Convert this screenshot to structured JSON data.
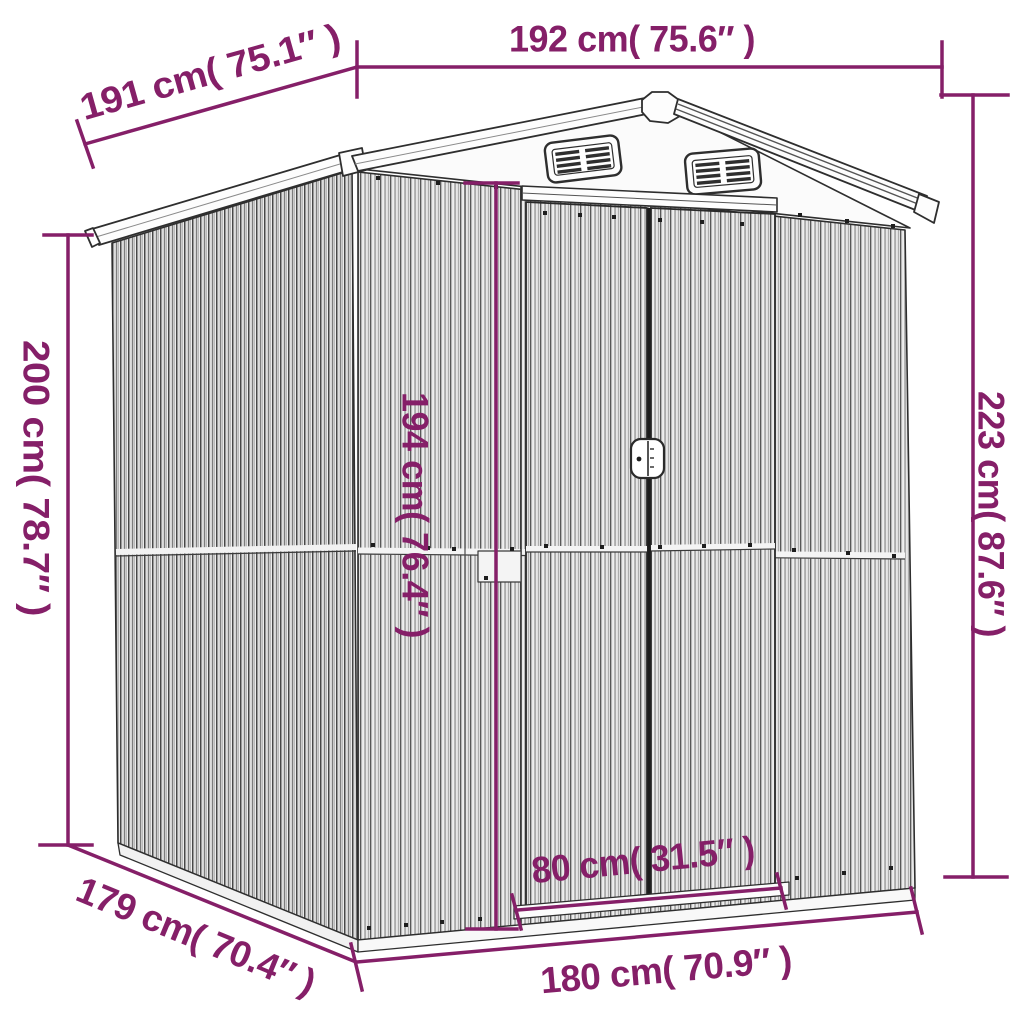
{
  "colors": {
    "dimension": "#851f68",
    "line_art": "#2e2e2e",
    "background": "#ffffff"
  },
  "drawing": {
    "subject": "garden-shed-line-art"
  },
  "dimensions": {
    "top_depth": {
      "cm": 191,
      "inch": 75.1,
      "label": "191 cm( 75.1″ )"
    },
    "top_width": {
      "cm": 192,
      "inch": 75.6,
      "label": "192 cm( 75.6″ )"
    },
    "left_height": {
      "cm": 200,
      "inch": 78.7,
      "label": "200 cm( 78.7″ )"
    },
    "right_height": {
      "cm": 223,
      "inch": 87.6,
      "label": "223 cm( 87.6″ )"
    },
    "door_height": {
      "cm": 194,
      "inch": 76.4,
      "label": "194 cm( 76.4″ )"
    },
    "door_width": {
      "cm": 80,
      "inch": 31.5,
      "label": "80 cm( 31.5″ )"
    },
    "base_width": {
      "cm": 180,
      "inch": 70.9,
      "label": "180 cm( 70.9″ )"
    },
    "base_depth": {
      "cm": 179,
      "inch": 70.4,
      "label": "179 cm( 70.4″ )"
    }
  }
}
